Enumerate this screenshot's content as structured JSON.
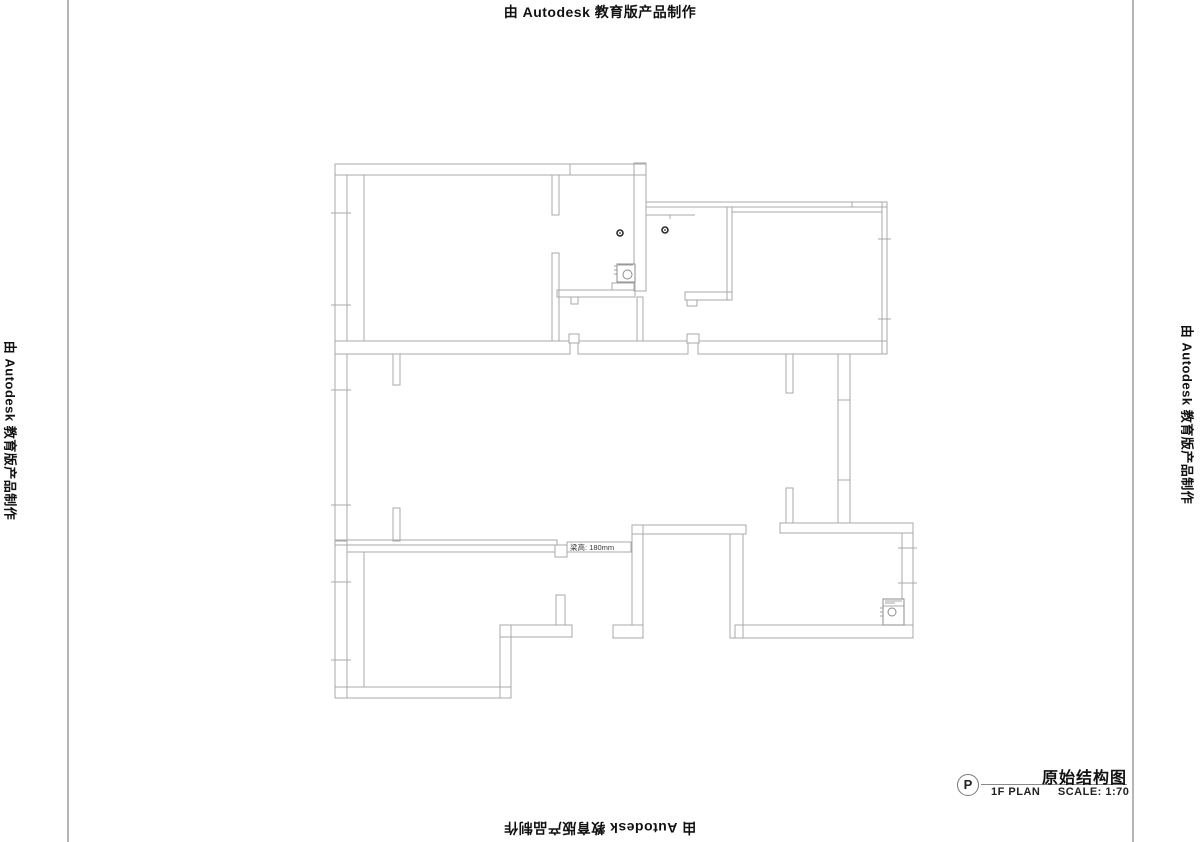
{
  "banner": {
    "text": "由 Autodesk 教育版产品制作"
  },
  "title_block": {
    "marker_letter": "P",
    "drawing_title": "原始结构图",
    "plan_label": "1F PLAN",
    "scale_label": "SCALE: 1:70"
  },
  "beam_label": "梁高: 180mm",
  "colors": {
    "wall_line": "#a9a9a9",
    "frame_line": "#b6b6b6",
    "banner_text": "#111111",
    "detail_line": "#8c8c8c",
    "dot": "#2b2b2b",
    "label_text": "#3a3a3a"
  },
  "floor_plan": {
    "walls": [
      [
        335,
        164,
        311,
        11
      ],
      [
        335,
        175,
        12,
        166
      ],
      [
        552,
        175,
        7,
        40
      ],
      [
        552,
        253,
        7,
        88
      ],
      [
        634,
        163,
        12,
        128
      ],
      [
        557,
        290,
        78,
        7
      ],
      [
        637,
        297,
        6,
        44
      ],
      [
        646,
        202,
        241,
        5
      ],
      [
        882,
        202,
        5,
        152
      ],
      [
        727,
        207,
        5,
        93
      ],
      [
        685,
        292,
        47,
        8
      ],
      [
        335,
        341,
        235,
        13
      ],
      [
        578,
        341,
        110,
        13
      ],
      [
        698,
        341,
        189,
        13
      ],
      [
        335,
        354,
        12,
        187
      ],
      [
        393,
        354,
        7,
        31
      ],
      [
        393,
        508,
        7,
        33
      ],
      [
        335,
        540,
        222,
        5
      ],
      [
        838,
        354,
        12,
        169
      ],
      [
        786,
        354,
        7,
        39
      ],
      [
        786,
        488,
        7,
        35
      ],
      [
        335,
        541,
        12,
        157
      ],
      [
        335,
        687,
        176,
        11
      ],
      [
        500,
        625,
        11,
        73
      ],
      [
        500,
        625,
        72,
        12
      ],
      [
        556,
        595,
        9,
        30
      ],
      [
        632,
        525,
        11,
        100
      ],
      [
        632,
        525,
        114,
        9
      ],
      [
        613,
        625,
        30,
        13
      ],
      [
        780,
        523,
        133,
        10
      ],
      [
        902,
        533,
        11,
        92
      ],
      [
        735,
        625,
        178,
        13
      ],
      [
        730,
        534,
        13,
        104
      ]
    ],
    "tabs": [
      [
        569,
        334,
        10,
        9
      ],
      [
        687,
        334,
        12,
        9
      ],
      [
        571,
        297,
        7,
        7
      ],
      [
        687,
        300,
        10,
        6
      ],
      [
        555,
        545,
        12,
        12
      ]
    ],
    "lines": [
      [
        364,
        175,
        364,
        341
      ],
      [
        732,
        212,
        882,
        212
      ],
      [
        646,
        215,
        695,
        215
      ],
      [
        670,
        215,
        670,
        219
      ],
      [
        364,
        552,
        364,
        687
      ],
      [
        347,
        552,
        555,
        552
      ]
    ],
    "ticks": [
      [
        331,
        213,
        351,
        213
      ],
      [
        331,
        305,
        351,
        305
      ],
      [
        331,
        390,
        351,
        390
      ],
      [
        331,
        505,
        351,
        505
      ],
      [
        331,
        582,
        351,
        582
      ],
      [
        331,
        660,
        351,
        660
      ],
      [
        878,
        239,
        891,
        239
      ],
      [
        878,
        319,
        891,
        319
      ],
      [
        898,
        548,
        917,
        548
      ],
      [
        898,
        583,
        917,
        583
      ],
      [
        838,
        400,
        850,
        400
      ],
      [
        838,
        480,
        850,
        480
      ],
      [
        570,
        164,
        570,
        175
      ],
      [
        852,
        202,
        852,
        207
      ]
    ],
    "dots": [
      {
        "cx": 620,
        "cy": 233,
        "r": 3
      },
      {
        "cx": 665,
        "cy": 230,
        "r": 3
      }
    ],
    "fixtures": [
      {
        "name": "bathroom-fixture",
        "box": [
          617,
          264,
          18,
          18
        ],
        "circle": {
          "cx": 627.5,
          "cy": 274.5,
          "r": 4.5
        },
        "extra_rects": [
          [
            612,
            283,
            23,
            7
          ]
        ],
        "extra_lines": [
          [
            614,
            266,
            617,
            266
          ],
          [
            614,
            270,
            617,
            270
          ],
          [
            614,
            274,
            617,
            274
          ],
          [
            618,
            265,
            633,
            265
          ]
        ]
      },
      {
        "name": "boiler-fixture",
        "box": [
          883,
          599,
          21,
          26
        ],
        "circle": {
          "cx": 892,
          "cy": 612,
          "r": 4
        },
        "extra_rects": [],
        "extra_lines": [
          [
            883,
            606,
            904,
            606
          ],
          [
            885,
            601,
            902,
            601
          ],
          [
            885,
            603,
            895,
            603
          ],
          [
            880,
            608,
            883,
            608
          ],
          [
            880,
            612,
            883,
            612
          ],
          [
            880,
            616,
            883,
            616
          ]
        ]
      }
    ],
    "beam_box": {
      "rect": [
        567,
        542,
        64,
        10
      ],
      "text_x": 570,
      "text_y": 550
    }
  }
}
